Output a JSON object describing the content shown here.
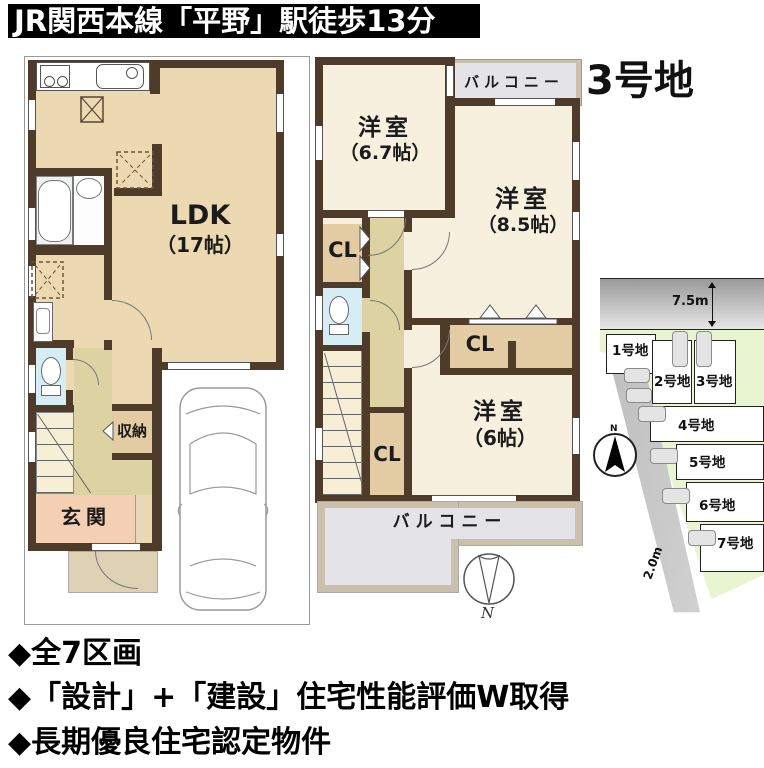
{
  "banner": {
    "title": "JR関西本線「平野」駅徒歩13分"
  },
  "page": {
    "lot_title": "3号地"
  },
  "floor1": {
    "ldk_name": "LDK",
    "ldk_size": "（17帖）",
    "storage_label": "収納",
    "entrance_label": "玄関"
  },
  "floor2": {
    "room_a_name": "洋室",
    "room_a_size": "（6.7帖）",
    "room_b_name": "洋室",
    "room_b_size": "（8.5帖）",
    "room_c_name": "洋室",
    "room_c_size": "（6帖）",
    "closet_left_label": "CL",
    "closet_lower_label": "CL",
    "closet_upper_label": "CL",
    "balcony_top_label": "バルコニー",
    "balcony_bottom_label": "バルコニー",
    "compass_label": "N"
  },
  "sitemap": {
    "road_top_width": "7.5m",
    "road_side_width": "2.0m",
    "compass_label": "N",
    "lots": [
      {
        "label": "1号地"
      },
      {
        "label": "2号地"
      },
      {
        "label": "3号地"
      },
      {
        "label": "4号地"
      },
      {
        "label": "5号地"
      },
      {
        "label": "6号地"
      },
      {
        "label": "7号地"
      }
    ]
  },
  "features": {
    "line1": "◆全7区画",
    "line2": "◆「設計」+「建設」住宅性能評価W取得",
    "line3": "◆長期優良住宅認定物件"
  },
  "colors": {
    "wall": "#4e3b2a",
    "floor_tan": "#ecd9b2",
    "floor_cream": "#f8f0df",
    "hall_olive": "#ddd3a2",
    "closet_tan": "#e3cba4",
    "entrance_salmon": "#f5cfb4",
    "toilet_blue": "#d6edf5",
    "balcony_gray": "#e4e4e8",
    "balcony_border": "#cbc0ab",
    "lot_green": "#e9f4d0",
    "road_gray": "#c9c9c9"
  }
}
